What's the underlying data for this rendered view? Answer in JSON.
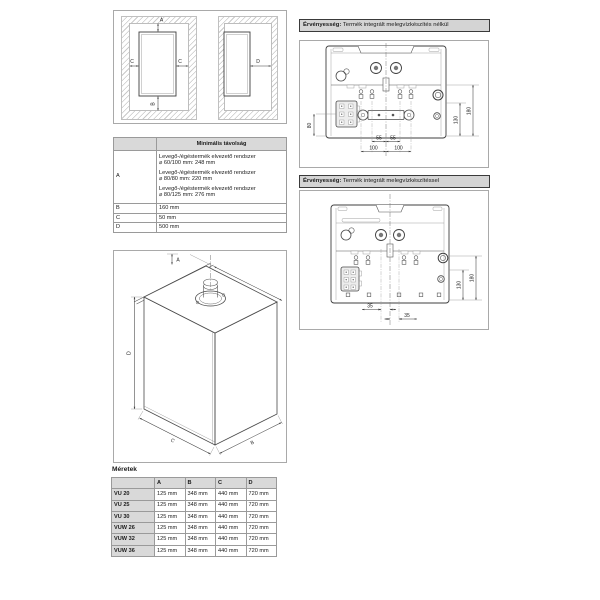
{
  "clearance": {
    "top": "A",
    "bottom": "B",
    "left": "C",
    "right": "C",
    "side": "D"
  },
  "min_table": {
    "title": "Minimális távolság",
    "row_a_key": "A",
    "row_a_items": [
      {
        "l1": "Levegő-/égéstermék elvezető rendszer",
        "l2": "⌀ 60/100 mm: 248 mm"
      },
      {
        "l1": "Levegő-/égéstermék elvezető rendszer",
        "l2": "⌀ 80/80 mm: 220 mm"
      },
      {
        "l1": "Levegő-/égéstermék elvezető rendszer",
        "l2": "⌀ 80/125 mm: 276 mm"
      }
    ],
    "row_b_key": "B",
    "row_b_val": "160 mm",
    "row_c_key": "C",
    "row_c_val": "50 mm",
    "row_d_key": "D",
    "row_d_val": "500 mm"
  },
  "iso": {
    "a": "A",
    "b": "B",
    "c": "C",
    "d": "D"
  },
  "meretek": {
    "title": "Méretek",
    "col_a": "A",
    "col_b": "B",
    "col_c": "C",
    "col_d": "D",
    "rows": [
      {
        "model": "VU 20",
        "a": "125 mm",
        "b": "348 mm",
        "c": "440 mm",
        "d": "720 mm"
      },
      {
        "model": "VU 25",
        "a": "125 mm",
        "b": "348 mm",
        "c": "440 mm",
        "d": "720 mm"
      },
      {
        "model": "VU 30",
        "a": "125 mm",
        "b": "348 mm",
        "c": "440 mm",
        "d": "720 mm"
      },
      {
        "model": "VUW 26",
        "a": "125 mm",
        "b": "348 mm",
        "c": "440 mm",
        "d": "720 mm"
      },
      {
        "model": "VUW 32",
        "a": "125 mm",
        "b": "348 mm",
        "c": "440 mm",
        "d": "720 mm"
      },
      {
        "model": "VUW 36",
        "a": "125 mm",
        "b": "348 mm",
        "c": "440 mm",
        "d": "720 mm"
      }
    ]
  },
  "validity1": {
    "label": "Érvényesség:",
    "text": " Termék integrált melegvízkészítés nélkül",
    "dim_left": "80",
    "dim_55l": "55",
    "dim_55r": "55",
    "dim_100l": "100",
    "dim_100r": "100",
    "dim_130": "130",
    "dim_180": "180"
  },
  "validity2": {
    "label": "Érvényesség:",
    "text": " Termék integrált melegvízkészítéssel",
    "dim_35l": "35",
    "dim_35r": "35",
    "dim_130": "130",
    "dim_180": "180"
  },
  "colors": {
    "header_gray": "#d9d9d9",
    "line_gray": "#555555"
  }
}
